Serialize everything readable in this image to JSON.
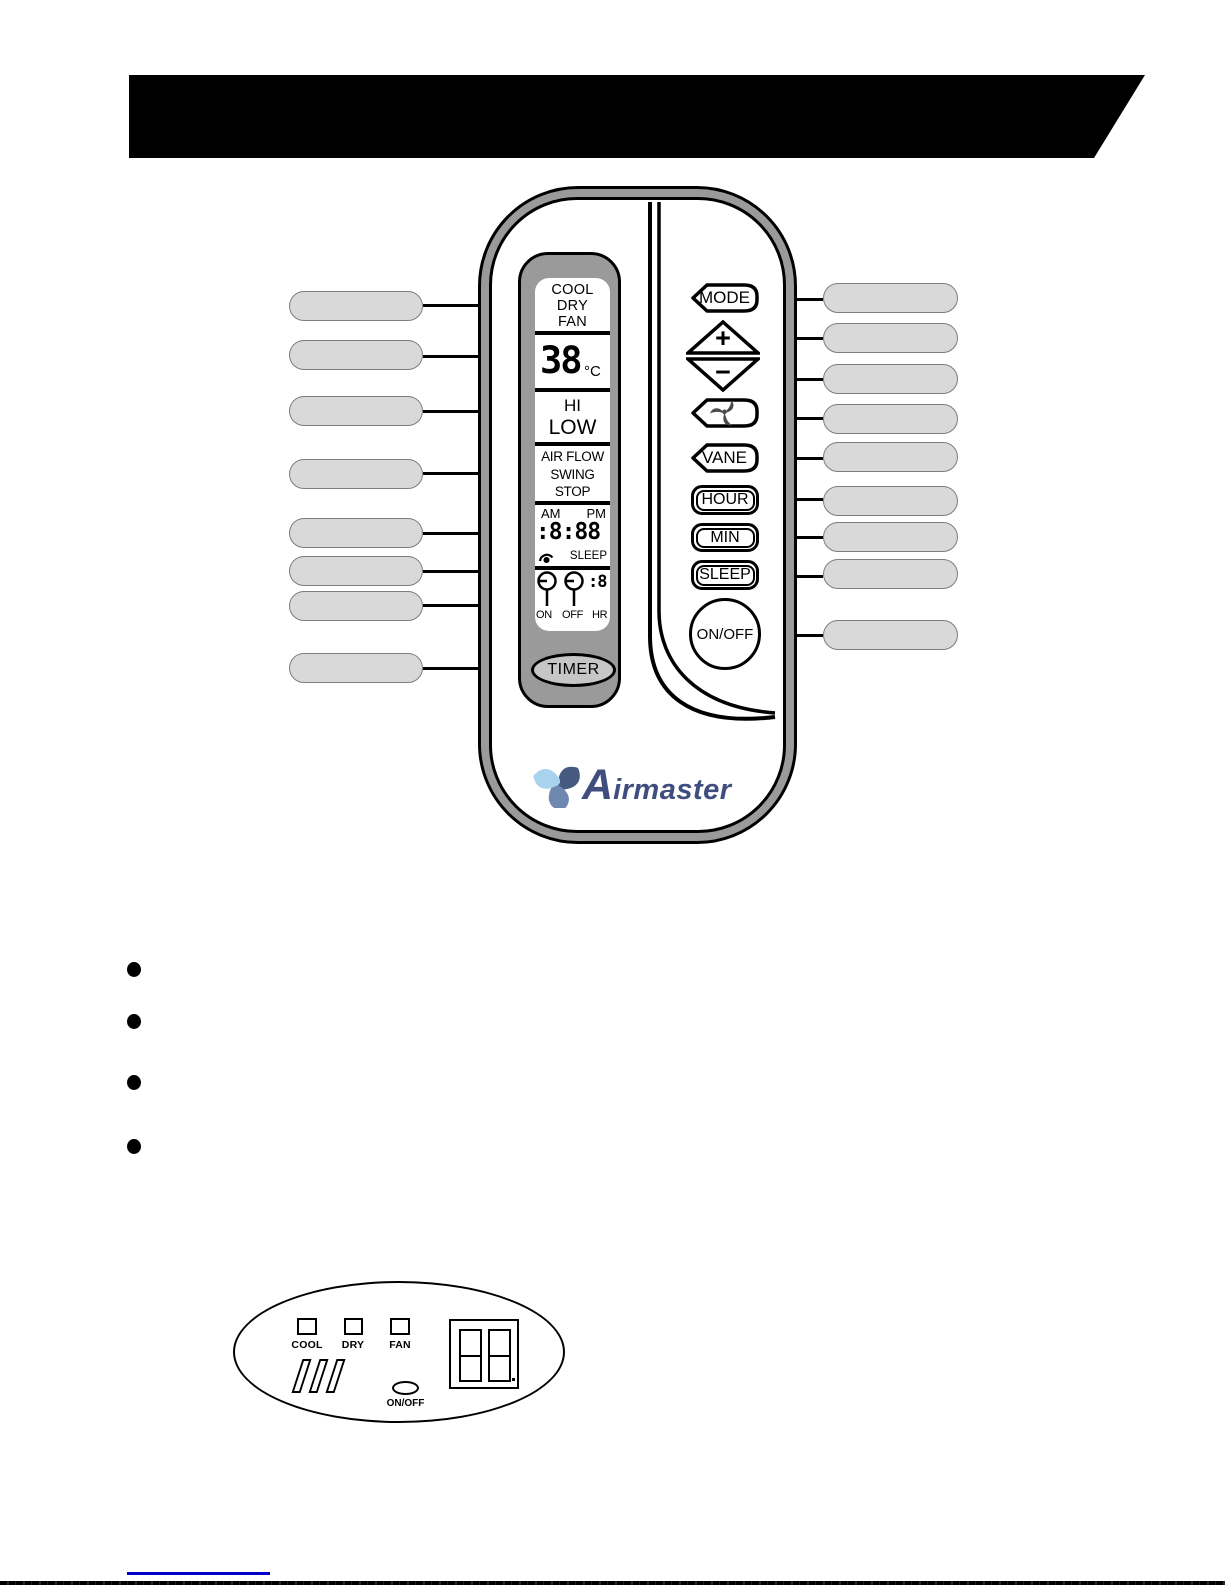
{
  "remote": {
    "lcd": {
      "modes": [
        "COOL",
        "DRY",
        "FAN"
      ],
      "temp_value": "38",
      "temp_unit": "°C",
      "fan_hi": "HI",
      "fan_low": "LOW",
      "airflow": [
        "AIR FLOW",
        "SWING",
        "STOP"
      ],
      "time": {
        "am": "AM",
        "pm": "PM",
        "digits": ":8:88",
        "sleep": "SLEEP"
      },
      "timer_row": {
        "on": "ON",
        "off": "OFF",
        "hr": "HR",
        "hr_digit": ":8"
      },
      "timer_button": "TIMER"
    },
    "buttons": {
      "mode": "MODE",
      "plus": "+",
      "minus": "−",
      "vane": "VANE",
      "hour": "HOUR",
      "min": "MIN",
      "sleep": "SLEEP",
      "onoff": "ON/OFF"
    },
    "logo": {
      "text_initial": "A",
      "text_rest": "irmaster"
    }
  },
  "indicator_panel": {
    "cool": "COOL",
    "dry": "DRY",
    "fan": "FAN",
    "onoff": "ON/OFF"
  },
  "colors": {
    "logo_dark": "#46597e",
    "logo_mid": "#6e88b0",
    "logo_light": "#a8d2ee",
    "logo_text": "#3f4e7e",
    "footer_line": "#0000cc",
    "body_gray": "#9a9a9a",
    "callout_gray": "#d9d9d9",
    "timer_gray": "#c6c6c6"
  }
}
